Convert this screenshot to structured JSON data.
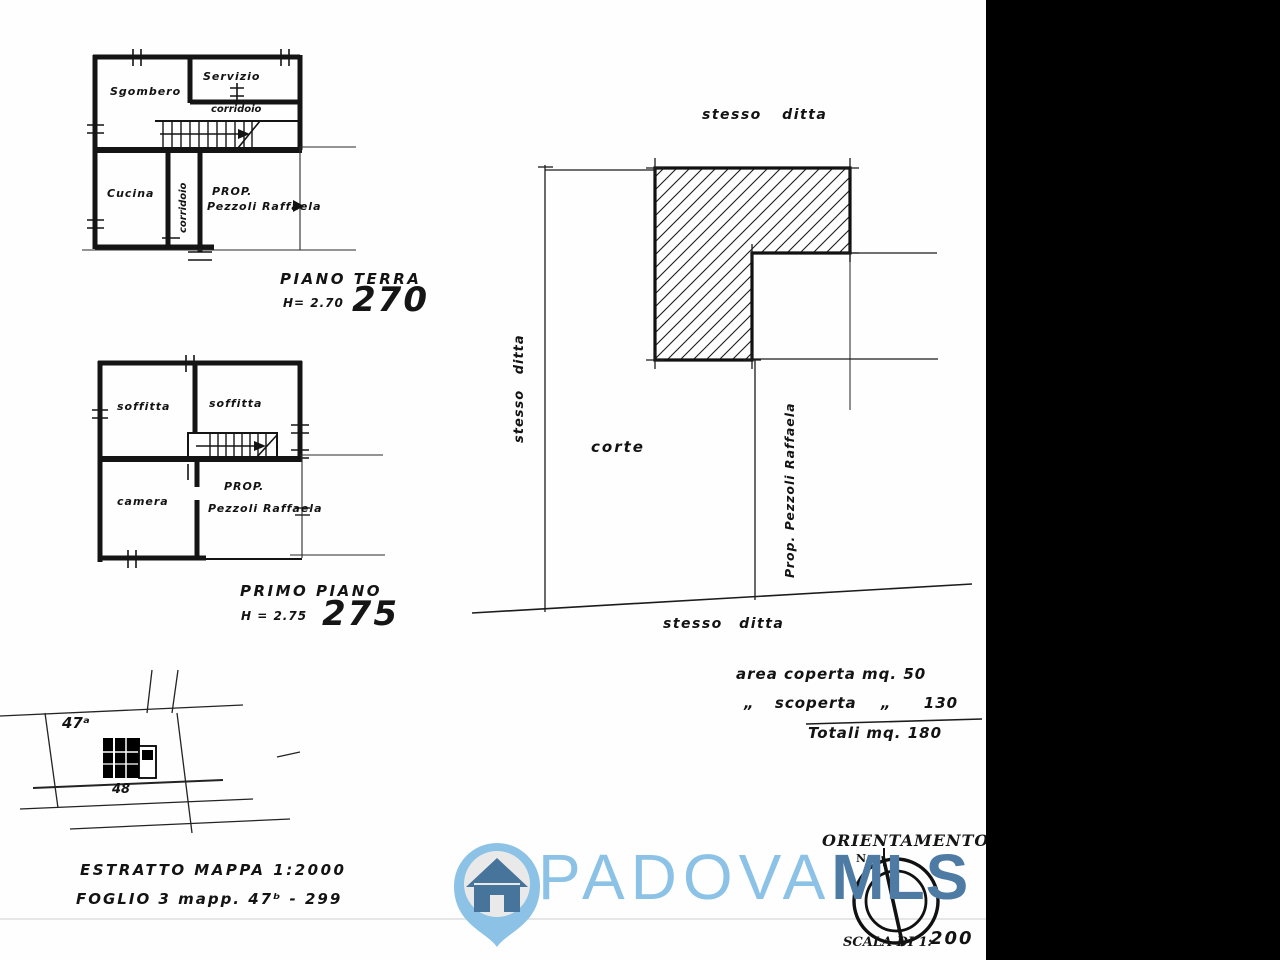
{
  "ground_floor": {
    "room_sgombero": "Sgombero",
    "room_servizio": "Servizio",
    "room_corridoio_h": "corridoio",
    "room_corridoio_v": "corridoio",
    "room_cucina": "Cucina",
    "prop_line1": "PROP.",
    "prop_line2": "Pezzoli Raffaela",
    "title": "PIANO TERRA",
    "height_label": "H= 2.70",
    "height_value": "270"
  },
  "first_floor": {
    "room_soffitta_left": "soffitta",
    "room_soffitta_right": "soffitta",
    "room_camera": "camera",
    "prop_line1": "PROP.",
    "prop_line2": "Pezzoli Raffaela",
    "title": "PRIMO PIANO",
    "height_label": "H = 2.75",
    "height_value": "275"
  },
  "site_plan": {
    "label_top": "stesso ditta",
    "label_left": "stesso ditta",
    "label_bottom": "stesso ditta",
    "label_corte": "corte",
    "label_owner": "Prop. Pezzoli Raffaela"
  },
  "area_summary": {
    "row1": "area coperta mq. 50",
    "row2_ditto1": "„",
    "row2_text": "scoperta",
    "row2_ditto2": "„",
    "row2_value": "130",
    "row3": "Totali mq. 180"
  },
  "map_extract": {
    "parcel_top": "47ᵃ",
    "parcel_bottom": "48",
    "caption_line1": "ESTRATTO MAPPA 1:2000",
    "caption_line2": "FOGLIO 3 mapp. 47ᵇ - 299"
  },
  "orientation": {
    "title": "ORIENTAMENTO",
    "north_label": "N.",
    "scale_label": "SCALA DI 1:",
    "scale_value": "200"
  },
  "logo": {
    "text_light": "PADOVA",
    "text_bold": "MLS",
    "color_light": "#8cc2e6",
    "color_dark": "#4e7ba3",
    "color_house": "#47749b"
  }
}
